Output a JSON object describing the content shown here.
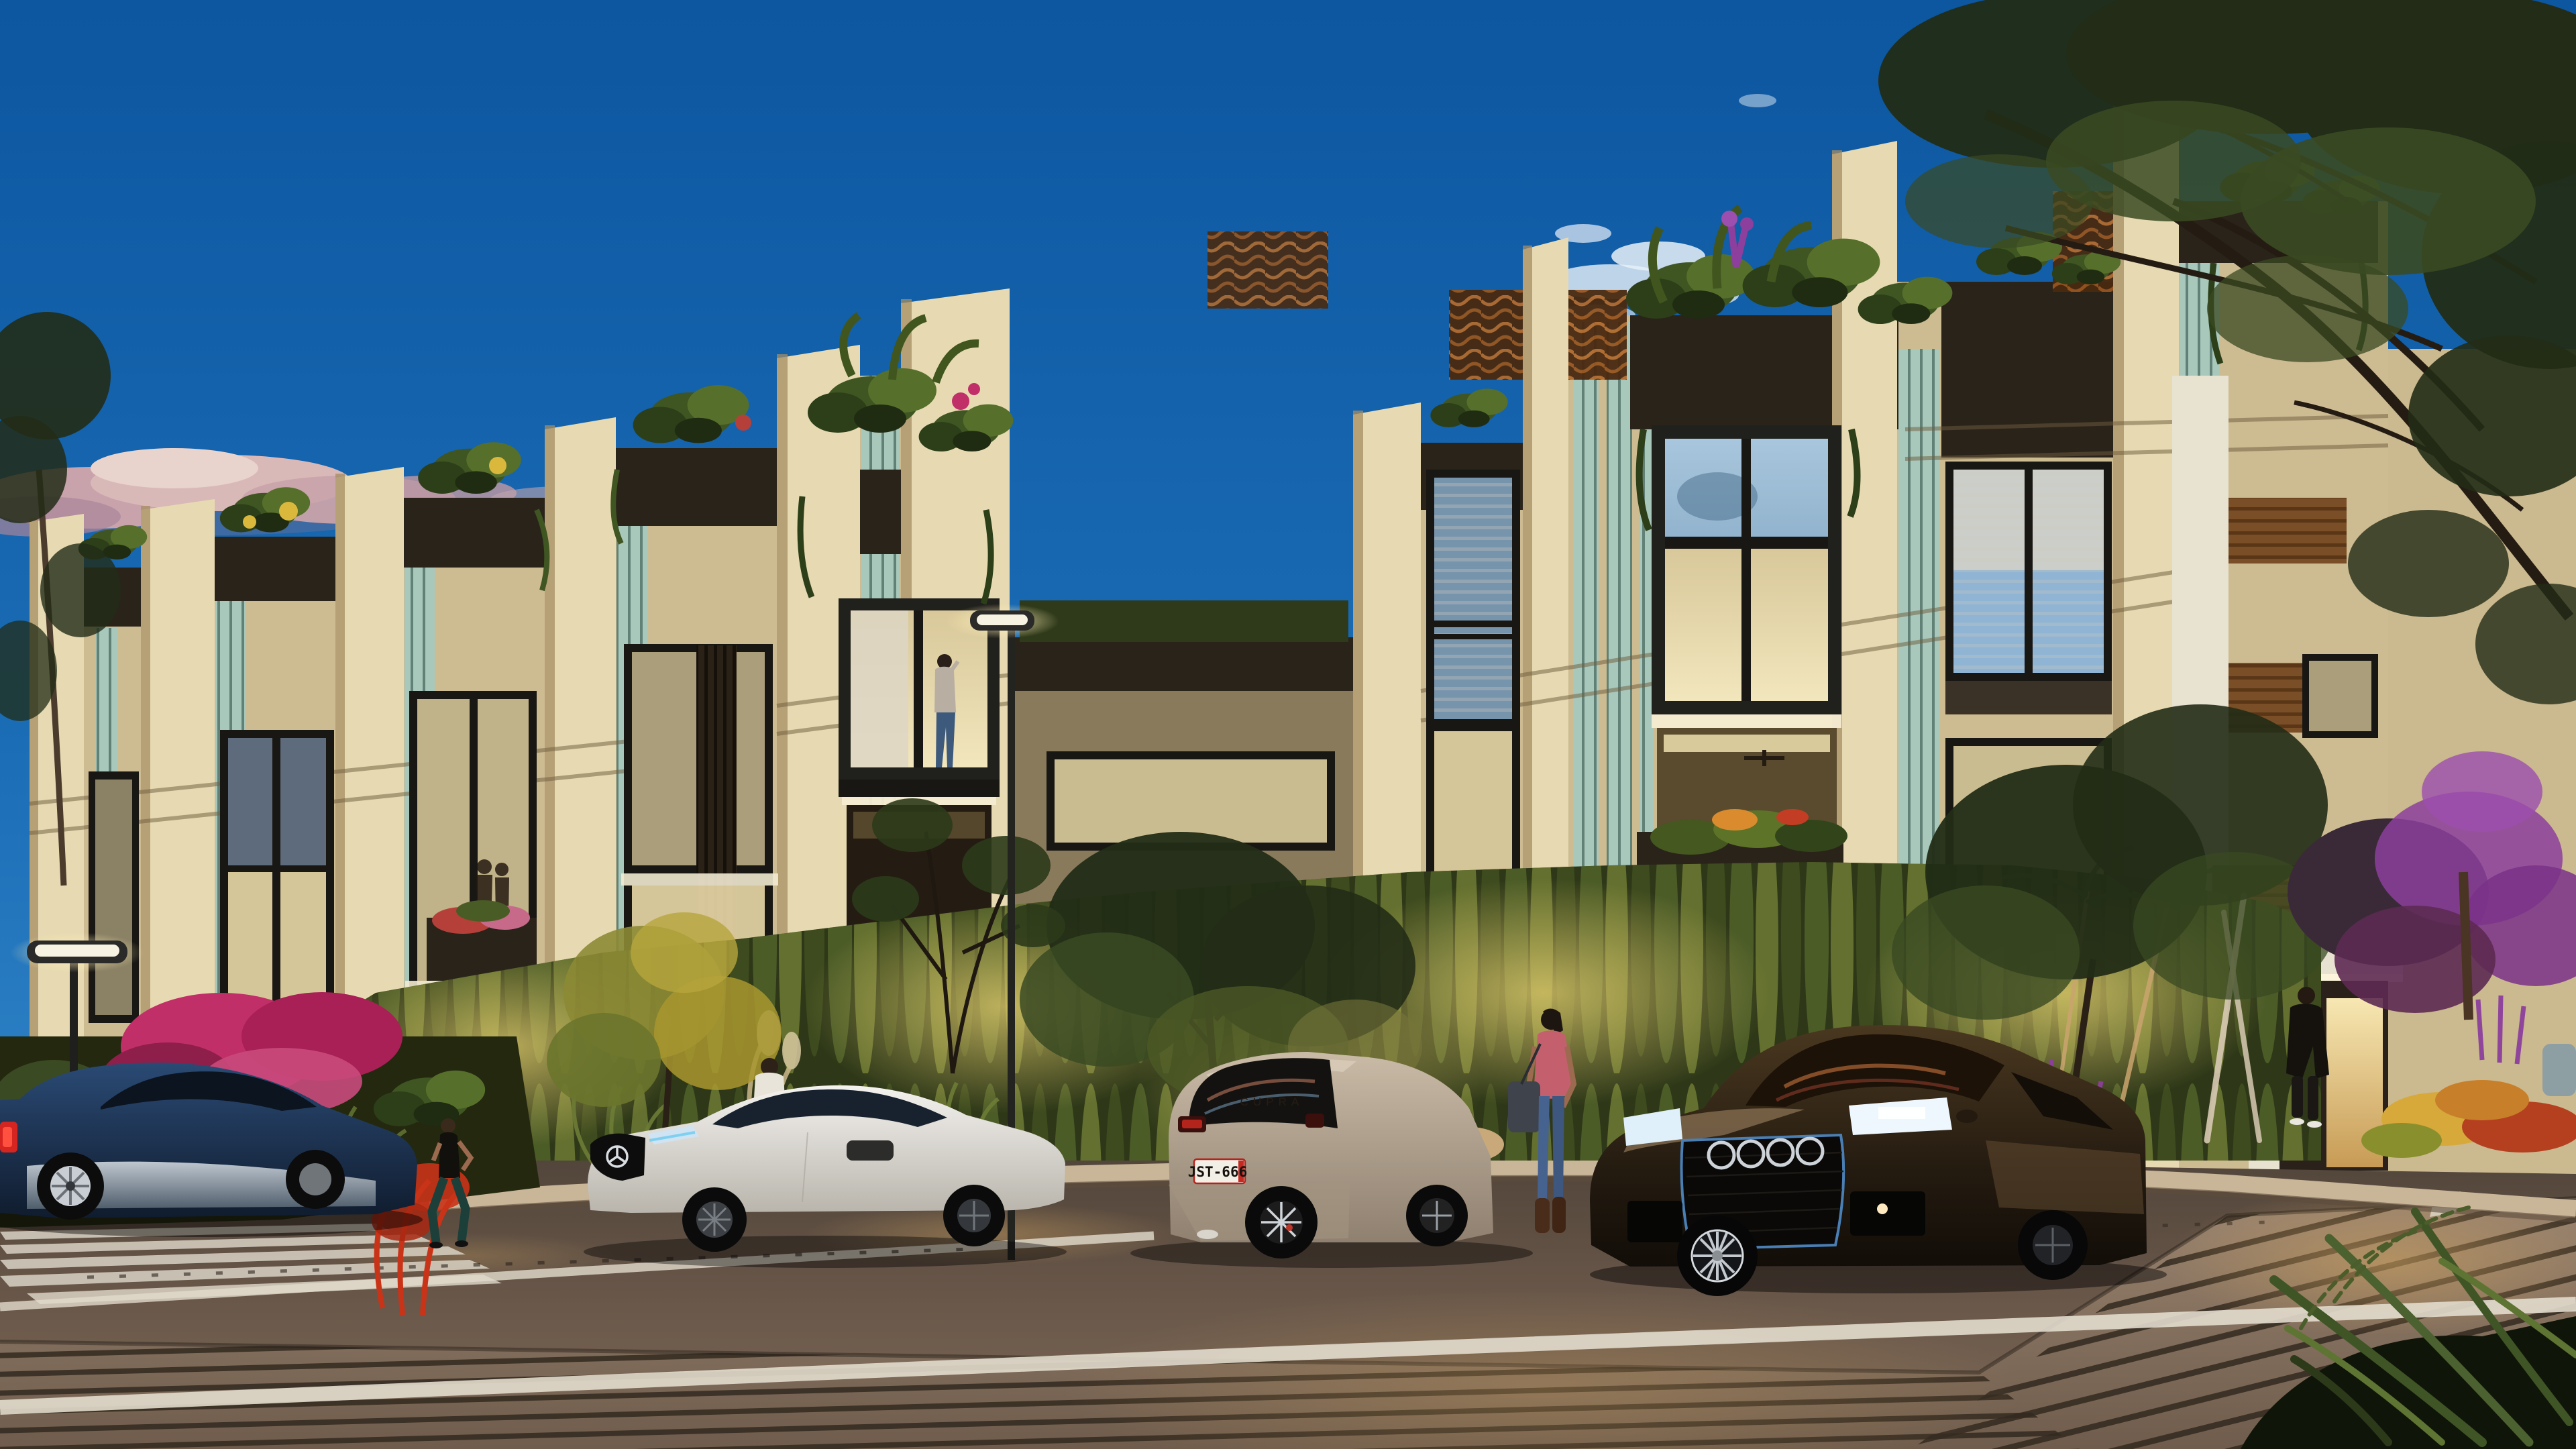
{
  "scene": {
    "description": "photorealistic dusk rendering of a modern three-storey townhouse row with sawtooth cream fins, rooftop planters, teal slat accents, glowing interiors, landscaped uplit hedge, four parked cars and pedestrians on a plank-paved street",
    "time_of_day": "dusk",
    "sky": "clear blue with pink-lit cloud band on left and small white clouds center"
  },
  "colors": {
    "sky_top": "#0d56a0",
    "sky_mid": "#1a6cb5",
    "sky_low": "#2f83c6",
    "sky_horizon": "#4793cd",
    "cloud_pink": "#cfa4ae",
    "cloud_light": "#e7d5d2",
    "wall_cream": "#e7dab2",
    "wall_cream_shade": "#cdbb92",
    "wall_cream_dark": "#a4placeholder",
    "white_wall": "#e8e2d0",
    "recess_dark": "#3b3227",
    "planter_dark": "#2a231a",
    "teal_slat": "#a9c8bc",
    "teal_slat_dark": "#6f9389",
    "frame_dark": "#191713",
    "glass_warm": "#ead9a8",
    "glass_blue": "#8fb4d4",
    "wood": "#7a4e26",
    "groove_line": "#6e5c3c",
    "hedge_dark": "#2e3818",
    "hedge_mid": "#5c6e2e",
    "hedge_lit": "#9aa348",
    "tree_dark": "#222c16",
    "tree_mid": "#3a4a22",
    "magenta_flower": "#c12f68",
    "purple_flower": "#8c3f9c",
    "red_flower": "#c93318",
    "yellow_flower": "#d9b83c",
    "road_far": "#4e4238",
    "road_near": "#7b6756",
    "plank": "#93placeholder",
    "plank_line": "#33291f",
    "curb_stone": "#c9b598",
    "lane_white": "#e2dccd",
    "lamp_light": "#f7f3e3"
  },
  "cars": {
    "mustang": {
      "name": "dark blue fastback coupe",
      "body_color": "#1c3552",
      "detail": "red tail light, chrome lower reflection, silver multi-spoke wheel"
    },
    "mercedes": {
      "name": "white sports coupe",
      "body_color": "#e9e7e1",
      "detail": "three-pointed star grille, dark wheels"
    },
    "cupra": {
      "name": "beige hatchback seen from rear",
      "body_color": "#b3a492",
      "plate": "JST-666",
      "badge": "CUPRA"
    },
    "audi": {
      "name": "bronze-black sedan seen from front",
      "body_color": "#261d12",
      "grille_accent": "#4a7fb5",
      "detail": "four-ring grille, lit headlights"
    }
  },
  "people": [
    {
      "id": "man-behind-white-car",
      "look": "white shirt, dark hair"
    },
    {
      "id": "woman-with-bag",
      "look": "pink top, blue jeans, brown boots, grey bag"
    },
    {
      "id": "jogger-woman",
      "look": "black tank, dark leggings"
    },
    {
      "id": "man-at-entrance",
      "look": "dark jacket and jeans, white shoes"
    },
    {
      "id": "person-in-window",
      "look": "standing at glass box window on phone"
    },
    {
      "id": "couple-in-window",
      "look": "two silhouettes in left window"
    }
  ],
  "street": {
    "lamps": 2,
    "crosswalk_stripes": 5,
    "lane_lines": 2,
    "dashed_line": true,
    "paving": "smooth road with plank-textured foreground"
  }
}
